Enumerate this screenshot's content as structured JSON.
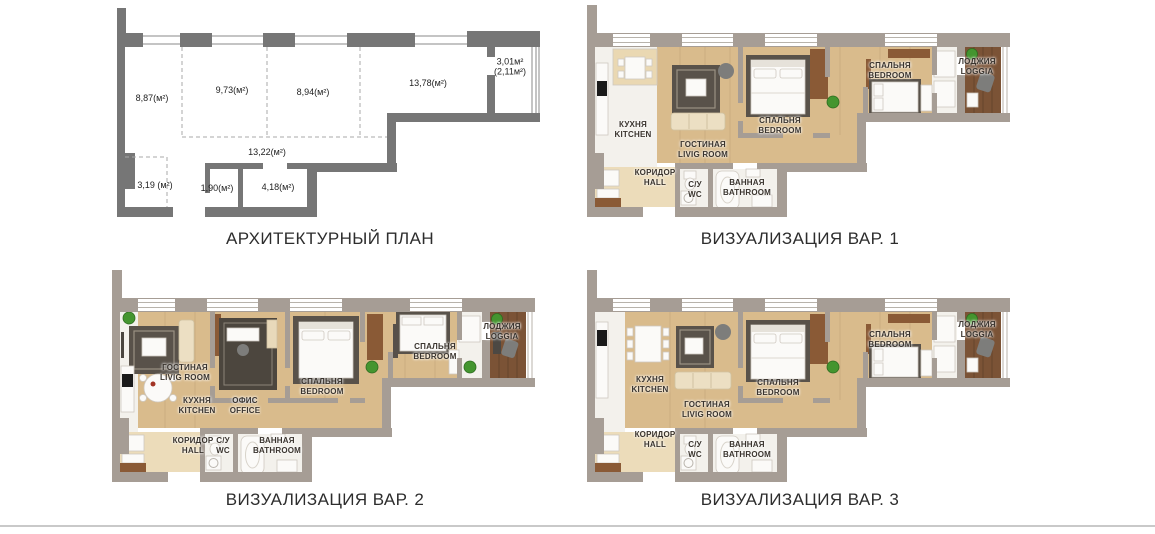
{
  "page": {
    "background": "#ffffff"
  },
  "colors": {
    "wall_arch": "#767676",
    "wall_viz": "#a69d95",
    "window_line": "#b8b3ab",
    "dashed_line": "#a8a8a8",
    "floor_wood": "#d9bb8c",
    "floor_loggia": "#7b5336",
    "floor_hall": "#ecdcba",
    "floor_white": "#f3f1ec",
    "rug_dark": "#59524a",
    "rug_office": "#4c463e",
    "accent_wood": "#8a5a36",
    "plant_green": "#44952f",
    "sofa_beige": "#ecdfc3",
    "appliance_black": "#1a1a1a",
    "chair_gray": "#7d7d7b",
    "furn_stroke": "#cfc9c0",
    "divider": "#c9c9c9"
  },
  "panels": {
    "architectural": {
      "title": "АРХИТЕКТУРНЫЙ ПЛАН",
      "areas": {
        "room1": "8,87(м²)",
        "room2": "9,73(м²)",
        "room3": "8,94(м²)",
        "room4": "13,78(м²)",
        "loggia_line1": "3,01м²",
        "loggia_line2": "(2,11м²)",
        "corridor": "13,22(м²)",
        "hall": "3,19 (м²)",
        "wc": "1,90(м²)",
        "bath": "4,18(м²)"
      }
    },
    "viz1": {
      "title": "ВИЗУАЛИЗАЦИЯ ВАР. 1",
      "rooms": {
        "kitchen": {
          "ru": "КУХНЯ",
          "en": "KITCHEN"
        },
        "living": {
          "ru": "ГОСТИНАЯ",
          "en": "LIVIG ROOM"
        },
        "bedroom1": {
          "ru": "СПАЛЬНЯ",
          "en": "BEDROOM"
        },
        "bedroom2": {
          "ru": "СПАЛЬНЯ",
          "en": "BEDROOM"
        },
        "loggia": {
          "ru": "ЛОДЖИЯ",
          "en": "LOGGIA"
        },
        "hall": {
          "ru": "КОРИДОР",
          "en": "HALL"
        },
        "wc": {
          "ru": "С/У",
          "en": "WC"
        },
        "bathroom": {
          "ru": "ВАННАЯ",
          "en": "BATHROOM"
        }
      }
    },
    "viz2": {
      "title": "ВИЗУАЛИЗАЦИЯ ВАР. 2",
      "rooms": {
        "living": {
          "ru": "ГОСТИНАЯ",
          "en": "LIVIG ROOM"
        },
        "kitchen": {
          "ru": "КУХНЯ",
          "en": "KITCHEN"
        },
        "office": {
          "ru": "ОФИС",
          "en": "OFFICE"
        },
        "bedroom1": {
          "ru": "СПАЛЬНЯ",
          "en": "BEDROOM"
        },
        "bedroom2": {
          "ru": "СПАЛЬНЯ",
          "en": "BEDROOM"
        },
        "loggia": {
          "ru": "ЛОДЖИЯ",
          "en": "LOGGIA"
        },
        "hall": {
          "ru": "КОРИДОР",
          "en": "HALL"
        },
        "wc": {
          "ru": "С/У",
          "en": "WC"
        },
        "bathroom": {
          "ru": "ВАННАЯ",
          "en": "BATHROOM"
        }
      }
    },
    "viz3": {
      "title": "ВИЗУАЛИЗАЦИЯ ВАР. 3",
      "rooms": {
        "kitchen": {
          "ru": "КУХНЯ",
          "en": "KITCHEN"
        },
        "living": {
          "ru": "ГОСТИНАЯ",
          "en": "LIVIG ROOM"
        },
        "bedroom1": {
          "ru": "СПАЛЬНЯ",
          "en": "BEDROOM"
        },
        "bedroom2": {
          "ru": "СПАЛЬНЯ",
          "en": "BEDROOM"
        },
        "loggia": {
          "ru": "ЛОДЖИЯ",
          "en": "LOGGIA"
        },
        "hall": {
          "ru": "КОРИДОР",
          "en": "HALL"
        },
        "wc": {
          "ru": "С/У",
          "en": "WC"
        },
        "bathroom": {
          "ru": "ВАННАЯ",
          "en": "BATHROOM"
        }
      }
    }
  }
}
